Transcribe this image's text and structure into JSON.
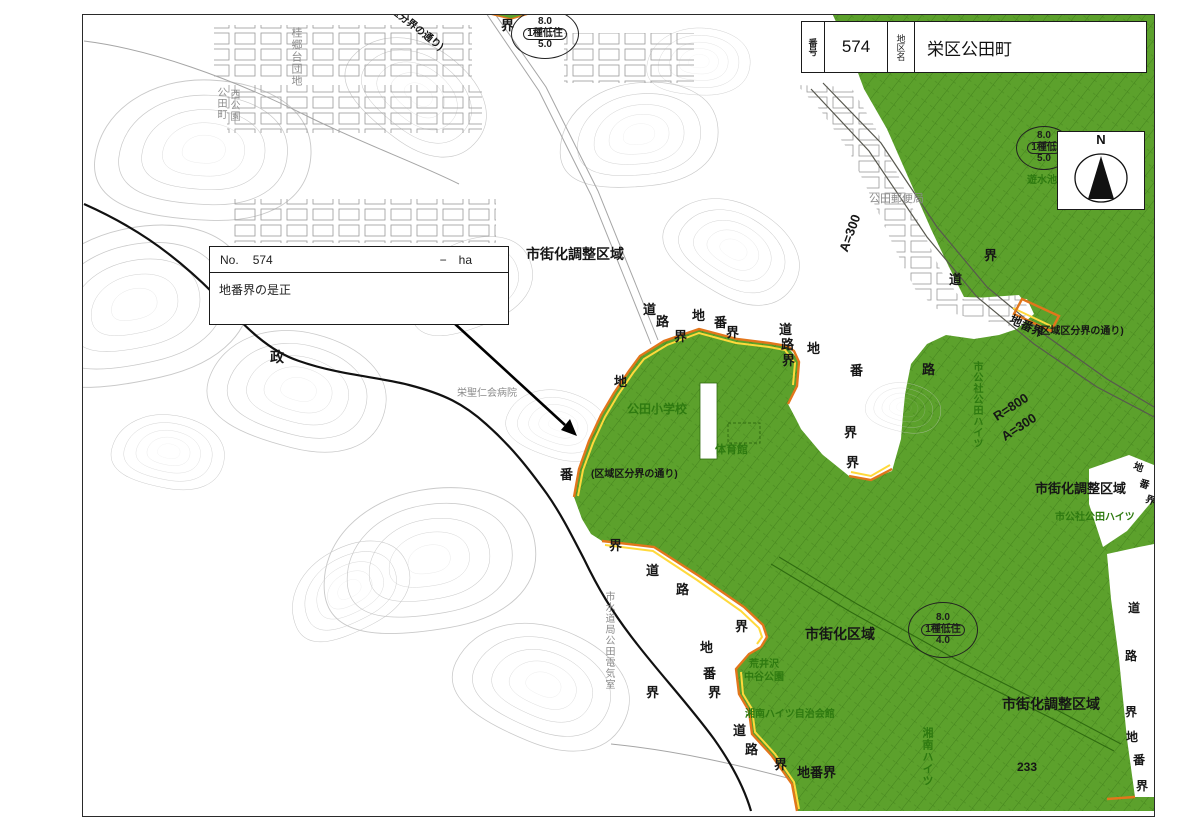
{
  "header": {
    "number_label": "番号",
    "number": "574",
    "district_label": "地区名",
    "district_name": "栄区公田町"
  },
  "info_box": {
    "no_label": "No.",
    "number": "574",
    "area_value": "−",
    "area_unit": "ha",
    "description": "地番界の是正"
  },
  "compass": {
    "north_label": "N"
  },
  "colors": {
    "zone_green": "#5ca12c",
    "zone_line_green": "#2f6b10",
    "boundary_orange": "#e2761b",
    "boundary_yellow": "#ffd93b",
    "contour_gray": "#c9c9c9"
  },
  "map": {
    "zoning_circles": [
      {
        "x": 512,
        "y": 10,
        "w": 66,
        "h": 48,
        "top": "8.0",
        "mid": "1種低住",
        "bot": "5.0"
      },
      {
        "x": 1017,
        "y": 127,
        "w": 54,
        "h": 42,
        "top": "8.0",
        "mid": "1種低",
        "bot": "5.0"
      },
      {
        "x": 909,
        "y": 603,
        "w": 68,
        "h": 54,
        "top": "8.0",
        "mid": "1種低住",
        "bot": "4.0"
      }
    ],
    "labels": [
      {
        "text": "市街化調整区域",
        "x": 527,
        "y": 248,
        "cls": "b",
        "fs": 14
      },
      {
        "text": "市街化調整区域",
        "x": 1036,
        "y": 483,
        "cls": "b",
        "fs": 13
      },
      {
        "text": "市街化調整区域",
        "x": 1003,
        "y": 698,
        "cls": "b",
        "fs": 14
      },
      {
        "text": "市街化区域",
        "x": 806,
        "y": 628,
        "cls": "b",
        "fs": 14
      },
      {
        "text": "政",
        "x": 271,
        "y": 351,
        "cls": "b",
        "fs": 14
      },
      {
        "text": "界",
        "x": 502,
        "y": 20,
        "cls": "b"
      },
      {
        "text": "道",
        "x": 644,
        "y": 304,
        "cls": "b"
      },
      {
        "text": "路",
        "x": 657,
        "y": 316,
        "cls": "b"
      },
      {
        "text": "界",
        "x": 675,
        "y": 331,
        "cls": "b"
      },
      {
        "text": "地",
        "x": 693,
        "y": 310,
        "cls": "b"
      },
      {
        "text": "番",
        "x": 715,
        "y": 317,
        "cls": "b"
      },
      {
        "text": "界",
        "x": 727,
        "y": 327,
        "cls": "b"
      },
      {
        "text": "道",
        "x": 780,
        "y": 324,
        "cls": "b"
      },
      {
        "text": "路",
        "x": 782,
        "y": 339,
        "cls": "b"
      },
      {
        "text": "界",
        "x": 783,
        "y": 355,
        "cls": "b"
      },
      {
        "text": "地",
        "x": 808,
        "y": 343,
        "cls": "b"
      },
      {
        "text": "番",
        "x": 851,
        "y": 365,
        "cls": "b"
      },
      {
        "text": "界",
        "x": 845,
        "y": 427,
        "cls": "b"
      },
      {
        "text": "界",
        "x": 847,
        "y": 457,
        "cls": "b"
      },
      {
        "text": "路",
        "x": 923,
        "y": 364,
        "cls": "b"
      },
      {
        "text": "道",
        "x": 950,
        "y": 274,
        "cls": "b"
      },
      {
        "text": "界",
        "x": 985,
        "y": 250,
        "cls": "b"
      },
      {
        "text": "地",
        "x": 615,
        "y": 376,
        "cls": "b"
      },
      {
        "text": "番",
        "x": 561,
        "y": 469,
        "cls": "b"
      },
      {
        "text": "界",
        "x": 610,
        "y": 540,
        "cls": "b"
      },
      {
        "text": "道",
        "x": 647,
        "y": 565,
        "cls": "b"
      },
      {
        "text": "路",
        "x": 677,
        "y": 584,
        "cls": "b"
      },
      {
        "text": "界",
        "x": 736,
        "y": 621,
        "cls": "b"
      },
      {
        "text": "界",
        "x": 647,
        "y": 687,
        "cls": "b"
      },
      {
        "text": "地",
        "x": 701,
        "y": 642,
        "cls": "b"
      },
      {
        "text": "番",
        "x": 704,
        "y": 668,
        "cls": "b"
      },
      {
        "text": "界",
        "x": 709,
        "y": 687,
        "cls": "b"
      },
      {
        "text": "道",
        "x": 734,
        "y": 725,
        "cls": "b"
      },
      {
        "text": "路",
        "x": 746,
        "y": 744,
        "cls": "b"
      },
      {
        "text": "界",
        "x": 775,
        "y": 759,
        "cls": "b"
      },
      {
        "text": "地番界",
        "x": 798,
        "y": 767,
        "cls": "b",
        "fs": 13
      },
      {
        "text": "道",
        "x": 1129,
        "y": 603,
        "cls": "b",
        "fs": 12
      },
      {
        "text": "路",
        "x": 1126,
        "y": 651,
        "cls": "b",
        "fs": 12
      },
      {
        "text": "界",
        "x": 1126,
        "y": 707,
        "cls": "b",
        "fs": 12
      },
      {
        "text": "地",
        "x": 1127,
        "y": 732,
        "cls": "b",
        "fs": 12
      },
      {
        "text": "番",
        "x": 1134,
        "y": 755,
        "cls": "b",
        "fs": 12
      },
      {
        "text": "界",
        "x": 1137,
        "y": 781,
        "cls": "b",
        "fs": 12
      },
      {
        "text": "地",
        "x": 1136,
        "y": 463,
        "cls": "b",
        "fs": 10,
        "r": 20
      },
      {
        "text": "番",
        "x": 1142,
        "y": 480,
        "cls": "b",
        "fs": 10,
        "r": 20
      },
      {
        "text": "界",
        "x": 1148,
        "y": 496,
        "cls": "b",
        "fs": 10,
        "r": 20
      },
      {
        "text": "(区域区分界の通り)",
        "x": 592,
        "y": 471,
        "cls": "b",
        "fs": 10
      },
      {
        "text": "(区域区分界の通り)",
        "x": 1038,
        "y": 328,
        "cls": "b",
        "fs": 10
      },
      {
        "text": "(区分界の通り)",
        "x": 393,
        "y": 5,
        "cls": "b",
        "fs": 10,
        "r": 38
      },
      {
        "text": "A=300",
        "x": 838,
        "y": 250,
        "cls": "b",
        "fs": 13,
        "r": -70
      },
      {
        "text": "R=800",
        "x": 992,
        "y": 413,
        "cls": "b",
        "fs": 13,
        "r": -33
      },
      {
        "text": "A=300",
        "x": 1000,
        "y": 433,
        "cls": "b",
        "fs": 13,
        "r": -33
      },
      {
        "text": "地番界",
        "x": 1014,
        "y": 314,
        "cls": "b",
        "fs": 12,
        "r": 25
      },
      {
        "text": "233",
        "x": 1018,
        "y": 762,
        "cls": "b",
        "fs": 12
      },
      {
        "text": "公田小学校",
        "x": 628,
        "y": 404,
        "cls": "g",
        "fs": 12
      },
      {
        "text": "体育館",
        "x": 716,
        "y": 446,
        "cls": "g",
        "fs": 11
      },
      {
        "text": "市公社公田ハイツ",
        "x": 1056,
        "y": 514,
        "cls": "g",
        "fs": 10
      },
      {
        "text": "荒井沢",
        "x": 750,
        "y": 661,
        "cls": "g",
        "fs": 10
      },
      {
        "text": "中谷公園",
        "x": 745,
        "y": 674,
        "cls": "g",
        "fs": 10
      },
      {
        "text": "湘南ハイツ自治会館",
        "x": 746,
        "y": 711,
        "cls": "g",
        "fs": 10
      },
      {
        "text": "遊水池",
        "x": 1028,
        "y": 177,
        "cls": "g",
        "fs": 10
      },
      {
        "text": "桂台第五",
        "x": 1090,
        "y": 62,
        "cls": "g",
        "fs": 10
      },
      {
        "text": "市公社公田ハイツ",
        "x": 972,
        "y": 362,
        "cls": "g v",
        "fs": 10
      },
      {
        "text": "湘南ハイツ",
        "x": 922,
        "y": 728,
        "cls": "g v",
        "fs": 11
      },
      {
        "text": "公田郵便局",
        "x": 870,
        "y": 195,
        "cls": "gr",
        "fs": 11
      },
      {
        "text": "栄聖仁会病院",
        "x": 458,
        "y": 390,
        "cls": "gr",
        "fs": 10
      },
      {
        "text": "桂郷台団地",
        "x": 291,
        "y": 28,
        "cls": "gr v",
        "fs": 11
      },
      {
        "text": "公田町",
        "x": 216,
        "y": 88,
        "cls": "gr v",
        "fs": 10
      },
      {
        "text": "西公園",
        "x": 229,
        "y": 90,
        "cls": "gr v",
        "fs": 10
      },
      {
        "text": "市水道局公田電気室",
        "x": 604,
        "y": 592,
        "cls": "gr v",
        "fs": 10
      }
    ]
  }
}
